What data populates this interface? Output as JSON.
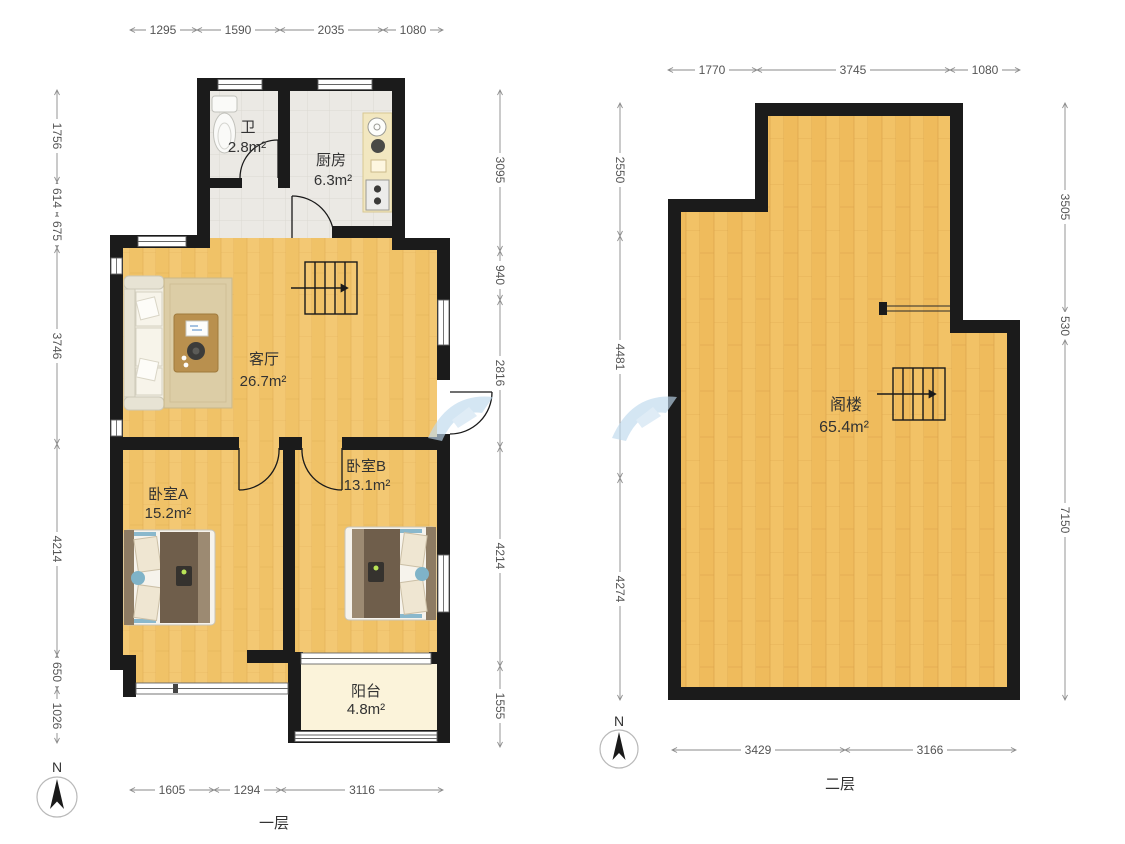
{
  "floor1": {
    "label": "一层",
    "compass": "N",
    "rooms": {
      "bath": {
        "name": "卫",
        "area": "2.8m²"
      },
      "kitchen": {
        "name": "厨房",
        "area": "6.3m²"
      },
      "living": {
        "name": "客厅",
        "area": "26.7m²"
      },
      "bedroomA": {
        "name": "卧室A",
        "area": "15.2m²"
      },
      "bedroomB": {
        "name": "卧室B",
        "area": "13.1m²"
      },
      "balcony": {
        "name": "阳台",
        "area": "4.8m²"
      }
    },
    "dims": {
      "top": [
        "1295",
        "1590",
        "2035",
        "1080"
      ],
      "left": [
        "1756",
        "614",
        "675",
        "3746",
        "4214",
        "650",
        "1026"
      ],
      "right": [
        "3095",
        "940",
        "2816",
        "4214",
        "1555"
      ],
      "bottom": [
        "1605",
        "1294",
        "3116"
      ]
    }
  },
  "floor2": {
    "label": "二层",
    "compass": "N",
    "rooms": {
      "attic": {
        "name": "阁楼",
        "area": "65.4m²"
      }
    },
    "dims": {
      "top": [
        "1770",
        "3745",
        "1080"
      ],
      "left": [
        "2550",
        "4481",
        "4274"
      ],
      "right": [
        "3505",
        "530",
        "7150"
      ],
      "bottom": [
        "3429",
        "3166"
      ]
    }
  },
  "colors": {
    "wall": "#1b1b1b",
    "wood_floor": "#f1c26a",
    "tile_floor": "#ebe9e4",
    "balcony_floor": "#fbf3da",
    "dim_line": "#8a8a8a",
    "teal_accent": "#7fb3c8",
    "duvet_brown": "#6f5e4b",
    "watermark_blue": "#bed9ee"
  }
}
